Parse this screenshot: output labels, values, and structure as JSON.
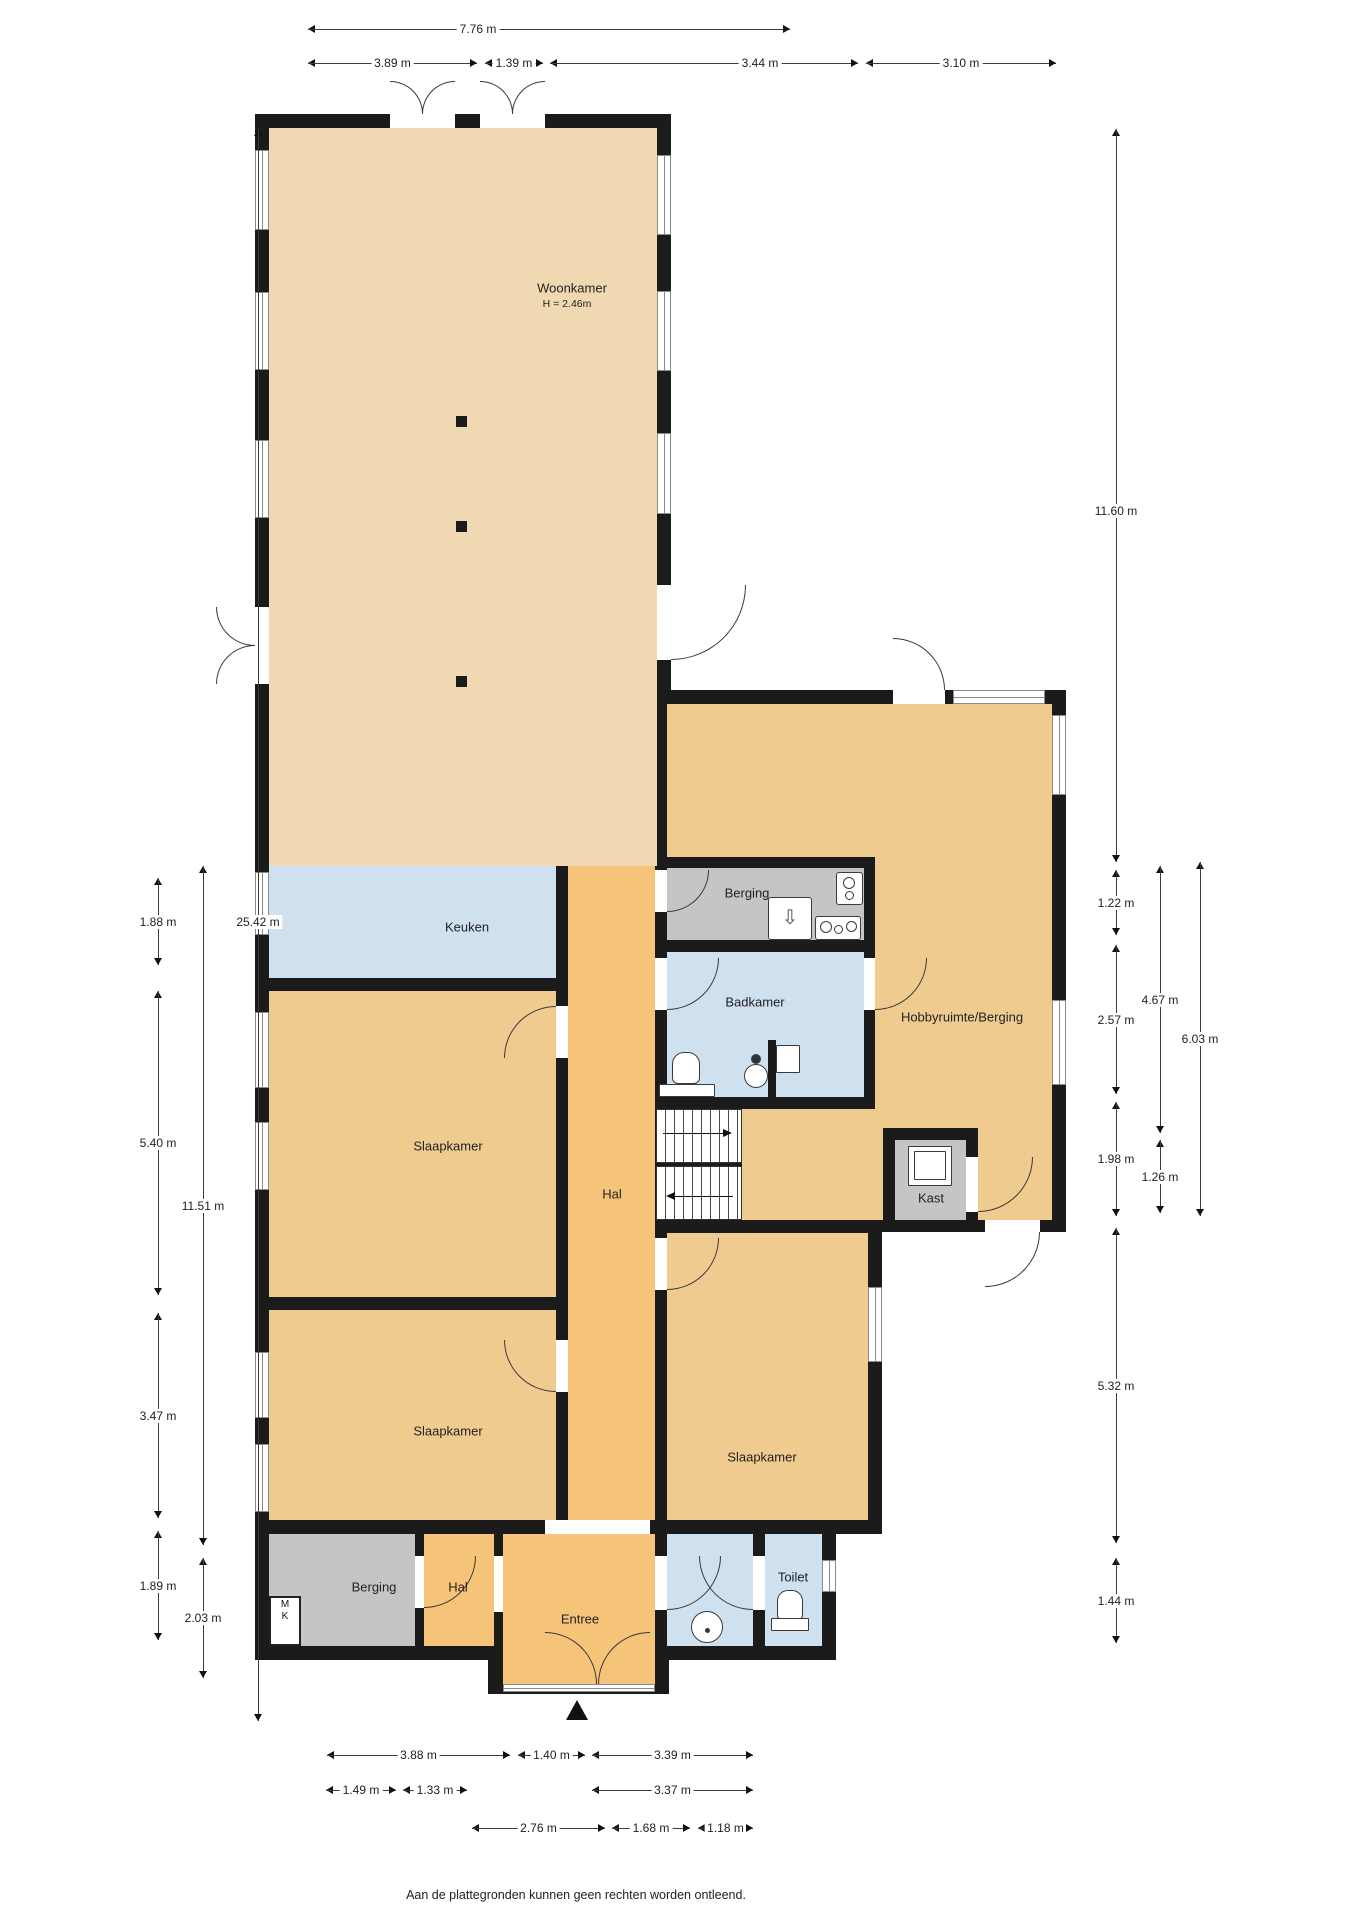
{
  "page": {
    "background": "#ffffff",
    "disclaimer": "Aan de plattegronden kunnen geen rechten worden ontleend."
  },
  "colors": {
    "wall": "#1b1b1b",
    "living_room_fill": "#f0d9b2",
    "bedroom_fill": "#efcb90",
    "hall_fill": "#f5c478",
    "wet_room_fill": "#cfe0ef",
    "storage_fill": "#c5c5c7",
    "dimension_line": "#3c3c3c"
  },
  "rooms": {
    "woonkamer": {
      "label": "Woonkamer",
      "ceiling_height": "H = 2.46m"
    },
    "keuken": {
      "label": "Keuken"
    },
    "berging_boven": {
      "label": "Berging"
    },
    "badkamer": {
      "label": "Badkamer"
    },
    "hobbyruimte": {
      "label": "Hobbyruimte/Berging"
    },
    "slaapkamer_links_1": {
      "label": "Slaapkamer"
    },
    "hal": {
      "label": "Hal"
    },
    "kast": {
      "label": "Kast"
    },
    "slaapkamer_links_2": {
      "label": "Slaapkamer"
    },
    "slaapkamer_rechts": {
      "label": "Slaapkamer"
    },
    "berging_beneden": {
      "label": "Berging"
    },
    "hal_beneden": {
      "label": "Hal"
    },
    "entree": {
      "label": "Entree"
    },
    "toilet": {
      "label": "Toilet"
    },
    "meterkast": {
      "line1": "M",
      "line2": "K"
    }
  },
  "dimensions": {
    "top": [
      {
        "label": "7.76 m"
      },
      {
        "label": "3.89 m"
      },
      {
        "label": "1.39 m"
      },
      {
        "label": "3.44 m"
      },
      {
        "label": "3.10 m"
      }
    ],
    "left": [
      {
        "label": "1.88 m"
      },
      {
        "label": "25.42 m"
      },
      {
        "label": "5.40 m"
      },
      {
        "label": "11.51 m"
      },
      {
        "label": "3.47 m"
      },
      {
        "label": "1.89 m"
      },
      {
        "label": "2.03 m"
      }
    ],
    "right": [
      {
        "label": "11.60 m"
      },
      {
        "label": "1.22 m"
      },
      {
        "label": "4.67 m"
      },
      {
        "label": "2.57 m"
      },
      {
        "label": "6.03 m"
      },
      {
        "label": "1.98 m"
      },
      {
        "label": "1.26 m"
      },
      {
        "label": "5.32 m"
      },
      {
        "label": "1.44 m"
      }
    ],
    "bottom": [
      {
        "label": "3.88 m"
      },
      {
        "label": "1.40 m"
      },
      {
        "label": "3.39 m"
      },
      {
        "label": "1.49 m"
      },
      {
        "label": "1.33 m"
      },
      {
        "label": "3.37 m"
      },
      {
        "label": "2.76 m"
      },
      {
        "label": "1.68 m"
      },
      {
        "label": "1.18 m"
      }
    ]
  }
}
